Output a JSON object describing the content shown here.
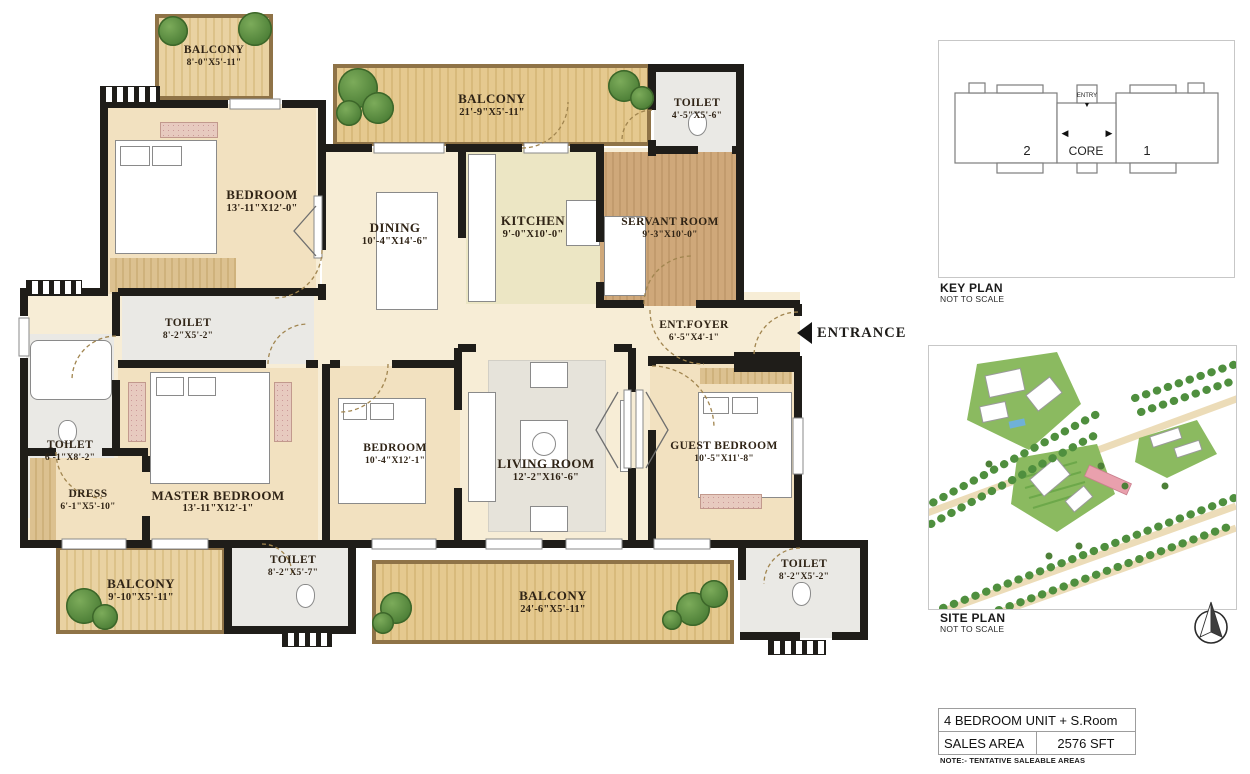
{
  "floor_plan": {
    "rooms": [
      {
        "name": "BALCONY",
        "dims": "8'-0\"X5'-11\""
      },
      {
        "name": "BEDROOM",
        "dims": "13'-11\"X12'-0\""
      },
      {
        "name": "BALCONY",
        "dims": "21'-9\"X5'-11\""
      },
      {
        "name": "DINING",
        "dims": "10'-4\"X14'-6\""
      },
      {
        "name": "KITCHEN",
        "dims": "9'-0\"X10'-0\""
      },
      {
        "name": "TOILET",
        "dims": "4'-5\"X5'-6\""
      },
      {
        "name": "SERVANT ROOM",
        "dims": "9'-3\"X10'-0\""
      },
      {
        "name": "TOILET",
        "dims": "8'-2\"X5'-2\""
      },
      {
        "name": "ENT.FOYER",
        "dims": "6'-5\"X4'-1\""
      },
      {
        "name": "TOILET",
        "dims": "6'-1\"X8'-2\""
      },
      {
        "name": "DRESS",
        "dims": "6'-1\"X5'-10\""
      },
      {
        "name": "MASTER BEDROOM",
        "dims": "13'-11\"X12'-1\""
      },
      {
        "name": "BEDROOM",
        "dims": "10'-4\"X12'-1\""
      },
      {
        "name": "LIVING ROOM",
        "dims": "12'-2\"X16'-6\""
      },
      {
        "name": "GUEST BEDROOM",
        "dims": "10'-5\"X11'-8\""
      },
      {
        "name": "BALCONY",
        "dims": "9'-10\"X5'-11\""
      },
      {
        "name": "TOILET",
        "dims": "8'-2\"X5'-7\""
      },
      {
        "name": "BALCONY",
        "dims": "24'-6\"X5'-11\""
      },
      {
        "name": "TOILET",
        "dims": "8'-2\"X5'-2\""
      }
    ],
    "entrance_label": "ENTRANCE"
  },
  "key_plan": {
    "title": "KEY PLAN",
    "scale_note": "NOT TO SCALE",
    "unit2": "2",
    "core": "CORE",
    "unit1": "1",
    "entry": "ENTRY",
    "entry_arrow": "▼",
    "arrow_left": "◀",
    "arrow_right": "▶"
  },
  "site_plan": {
    "title": "SITE PLAN",
    "scale_note": "NOT TO SCALE"
  },
  "summary": {
    "unit_type": "4 BEDROOM UNIT + S.Room",
    "sales_area_label": "SALES AREA",
    "sales_area_value": "2576 SFT",
    "note": "NOTE:- TENTATIVE SALEABLE AREAS"
  },
  "palette": {
    "wall": "#1f1d19",
    "floor_cream": "#f7edd6",
    "floor_beige": "#f2e1c0",
    "balcony_wood": "#e9d2a2",
    "servant_wood": "#cfa87a",
    "toilet_gray": "#eae9e5",
    "tree_green": "#4d7f37",
    "site_green": "#8bba60",
    "site_pink": "#e9a0ad"
  }
}
